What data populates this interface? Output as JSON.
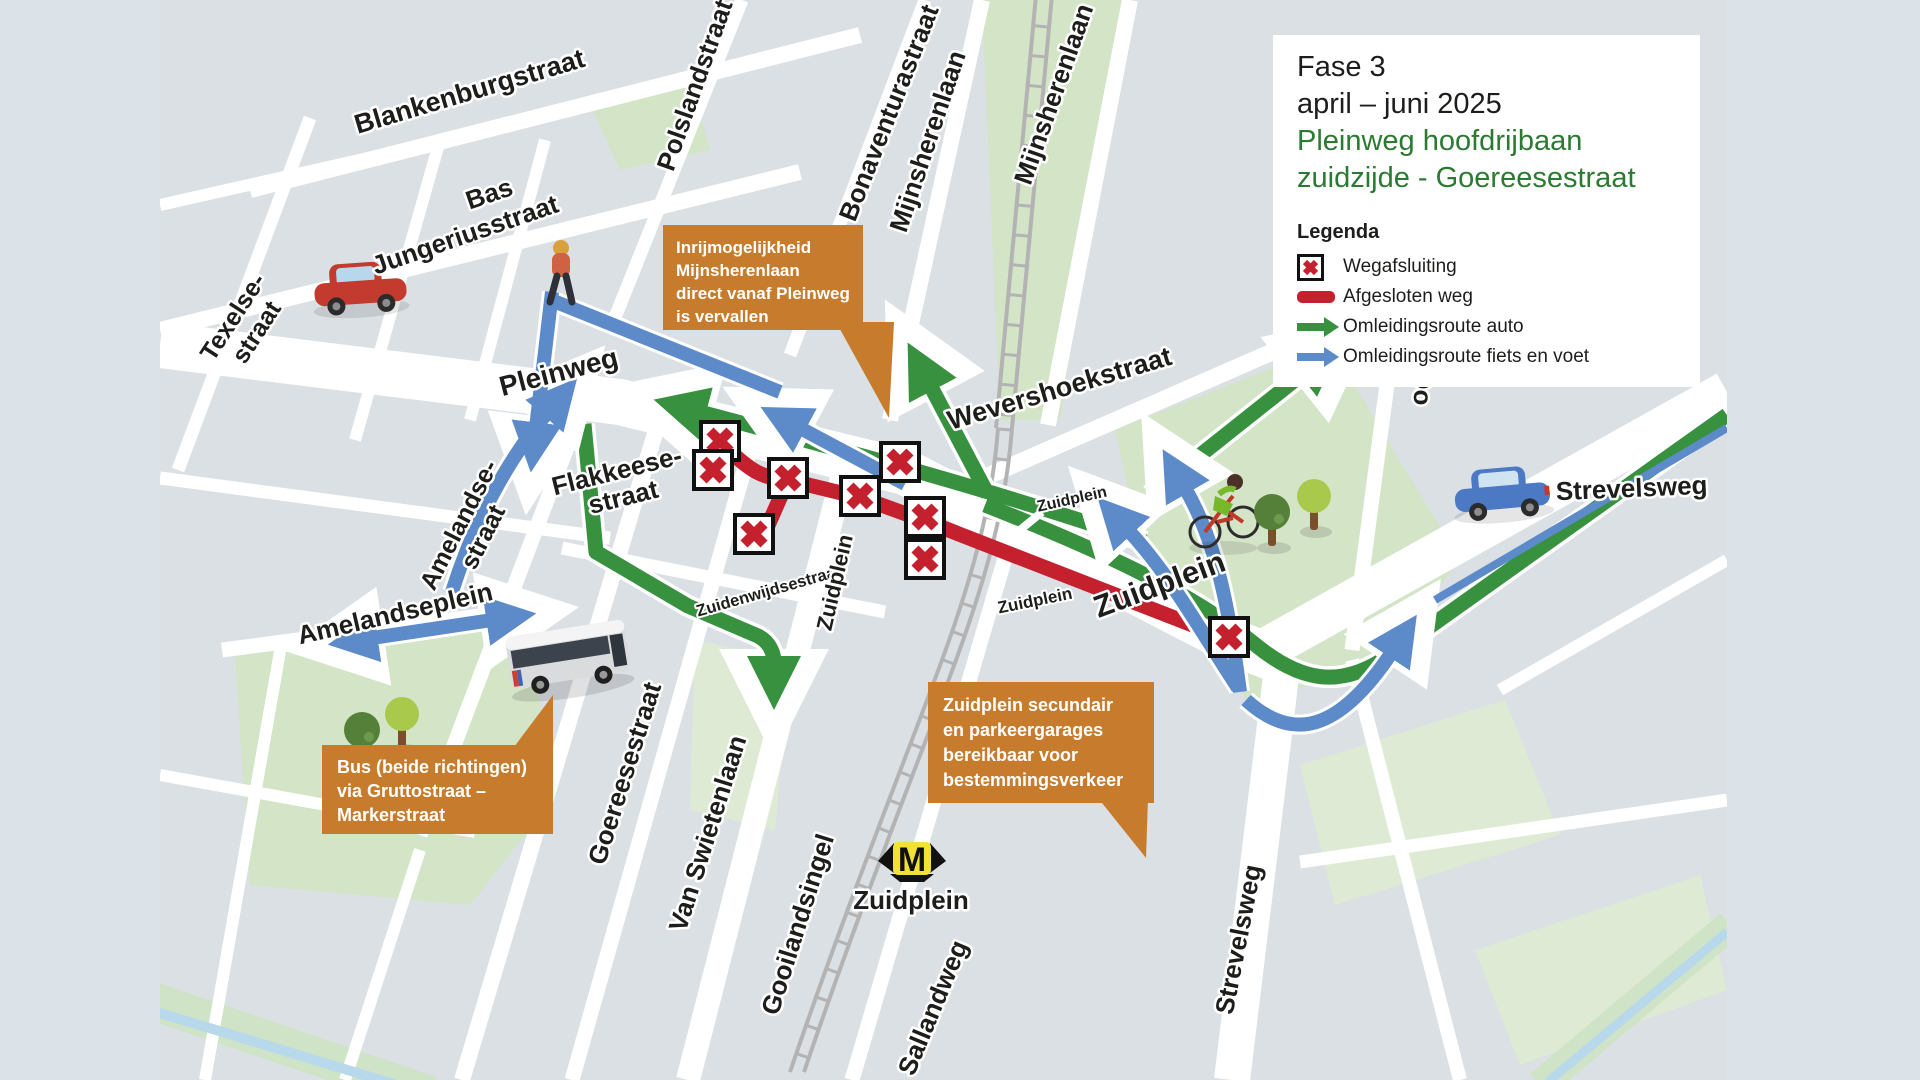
{
  "panel": {
    "phase": "Fase 3",
    "period": "april – juni 2025",
    "subtitle1": "Pleinweg hoofdrijbaan",
    "subtitle2": "zuidzijde - Goereesestraat",
    "legend_title": "Legenda",
    "legend": [
      {
        "icon": "closure-x-icon",
        "label": "Wegafsluiting"
      },
      {
        "icon": "closed-road-line",
        "label": "Afgesloten weg"
      },
      {
        "icon": "green-arrow-icon",
        "label": "Omleidingsroute auto"
      },
      {
        "icon": "blue-arrow-icon",
        "label": "Omleidingsroute fiets en voet"
      }
    ]
  },
  "callouts": [
    {
      "lines": [
        "Inrijmogelijkheid",
        "Mijnsherenlaan",
        "direct vanaf Pleinweg",
        "is vervallen"
      ]
    },
    {
      "lines": [
        "Bus (beide richtingen)",
        "via Gruttostraat –",
        "Markerstraat"
      ]
    },
    {
      "lines": [
        "Zuidplein secundair",
        "en parkeergarages",
        "bereikbaar voor",
        "bestemmingsverkeer"
      ]
    }
  ],
  "streets": {
    "blankenburgstraat": "Blankenburgstraat",
    "bas": "Bas",
    "jungeriusstraat": "Jungeriusstraat",
    "texelse_line1": "Texelse-",
    "texelse_line2": "straat",
    "polslandstraat": "Polslandstraat",
    "bonaventurastraat": "Bonaventurastraat",
    "mijnsherenlaan_w": "Mijnsherenlaan",
    "mijnsherenlaan_e": "Mijnsherenlaan",
    "pleinweg": "Pleinweg",
    "wevershoekstraat": "Wevershoekstraat",
    "flakkeese_line1": "Flakkeese-",
    "flakkeese_line2": "straat",
    "amelandse_line1": "Amelandse-",
    "amelandse_line2": "straat",
    "amelandseplein": "Amelandseplein",
    "zuidenwijdsestraat": "Zuidenwijdsestraat",
    "zuidplein_gooiland": "Zuidplein",
    "zuidplein_on_green": "Zuidplein",
    "zuidplein_small": "Zuidplein",
    "zuidplein_big": "Zuidplein",
    "goereesestraat": "Goereesestraat",
    "van_swietenlaan": "Van Swietenlaan",
    "gooilandsingel": "Gooilandsingel",
    "sallandweg": "Sallandweg",
    "strevelsweg_east": "Strevelsweg",
    "strevelsweg_south": "Strevelsweg",
    "dordtselaan_partial": "Do"
  },
  "metro": {
    "letter": "M",
    "station": "Zuidplein"
  },
  "colors": {
    "closed_road": "#c4202e",
    "detour_auto": "#38913f",
    "detour_bike": "#5d8bc9",
    "callout_bg": "#c67b2d",
    "title_green": "#2b7a31",
    "metro_yellow": "#f2e235",
    "map_block": "#dbe0e5",
    "park": "#d3e4c7"
  }
}
